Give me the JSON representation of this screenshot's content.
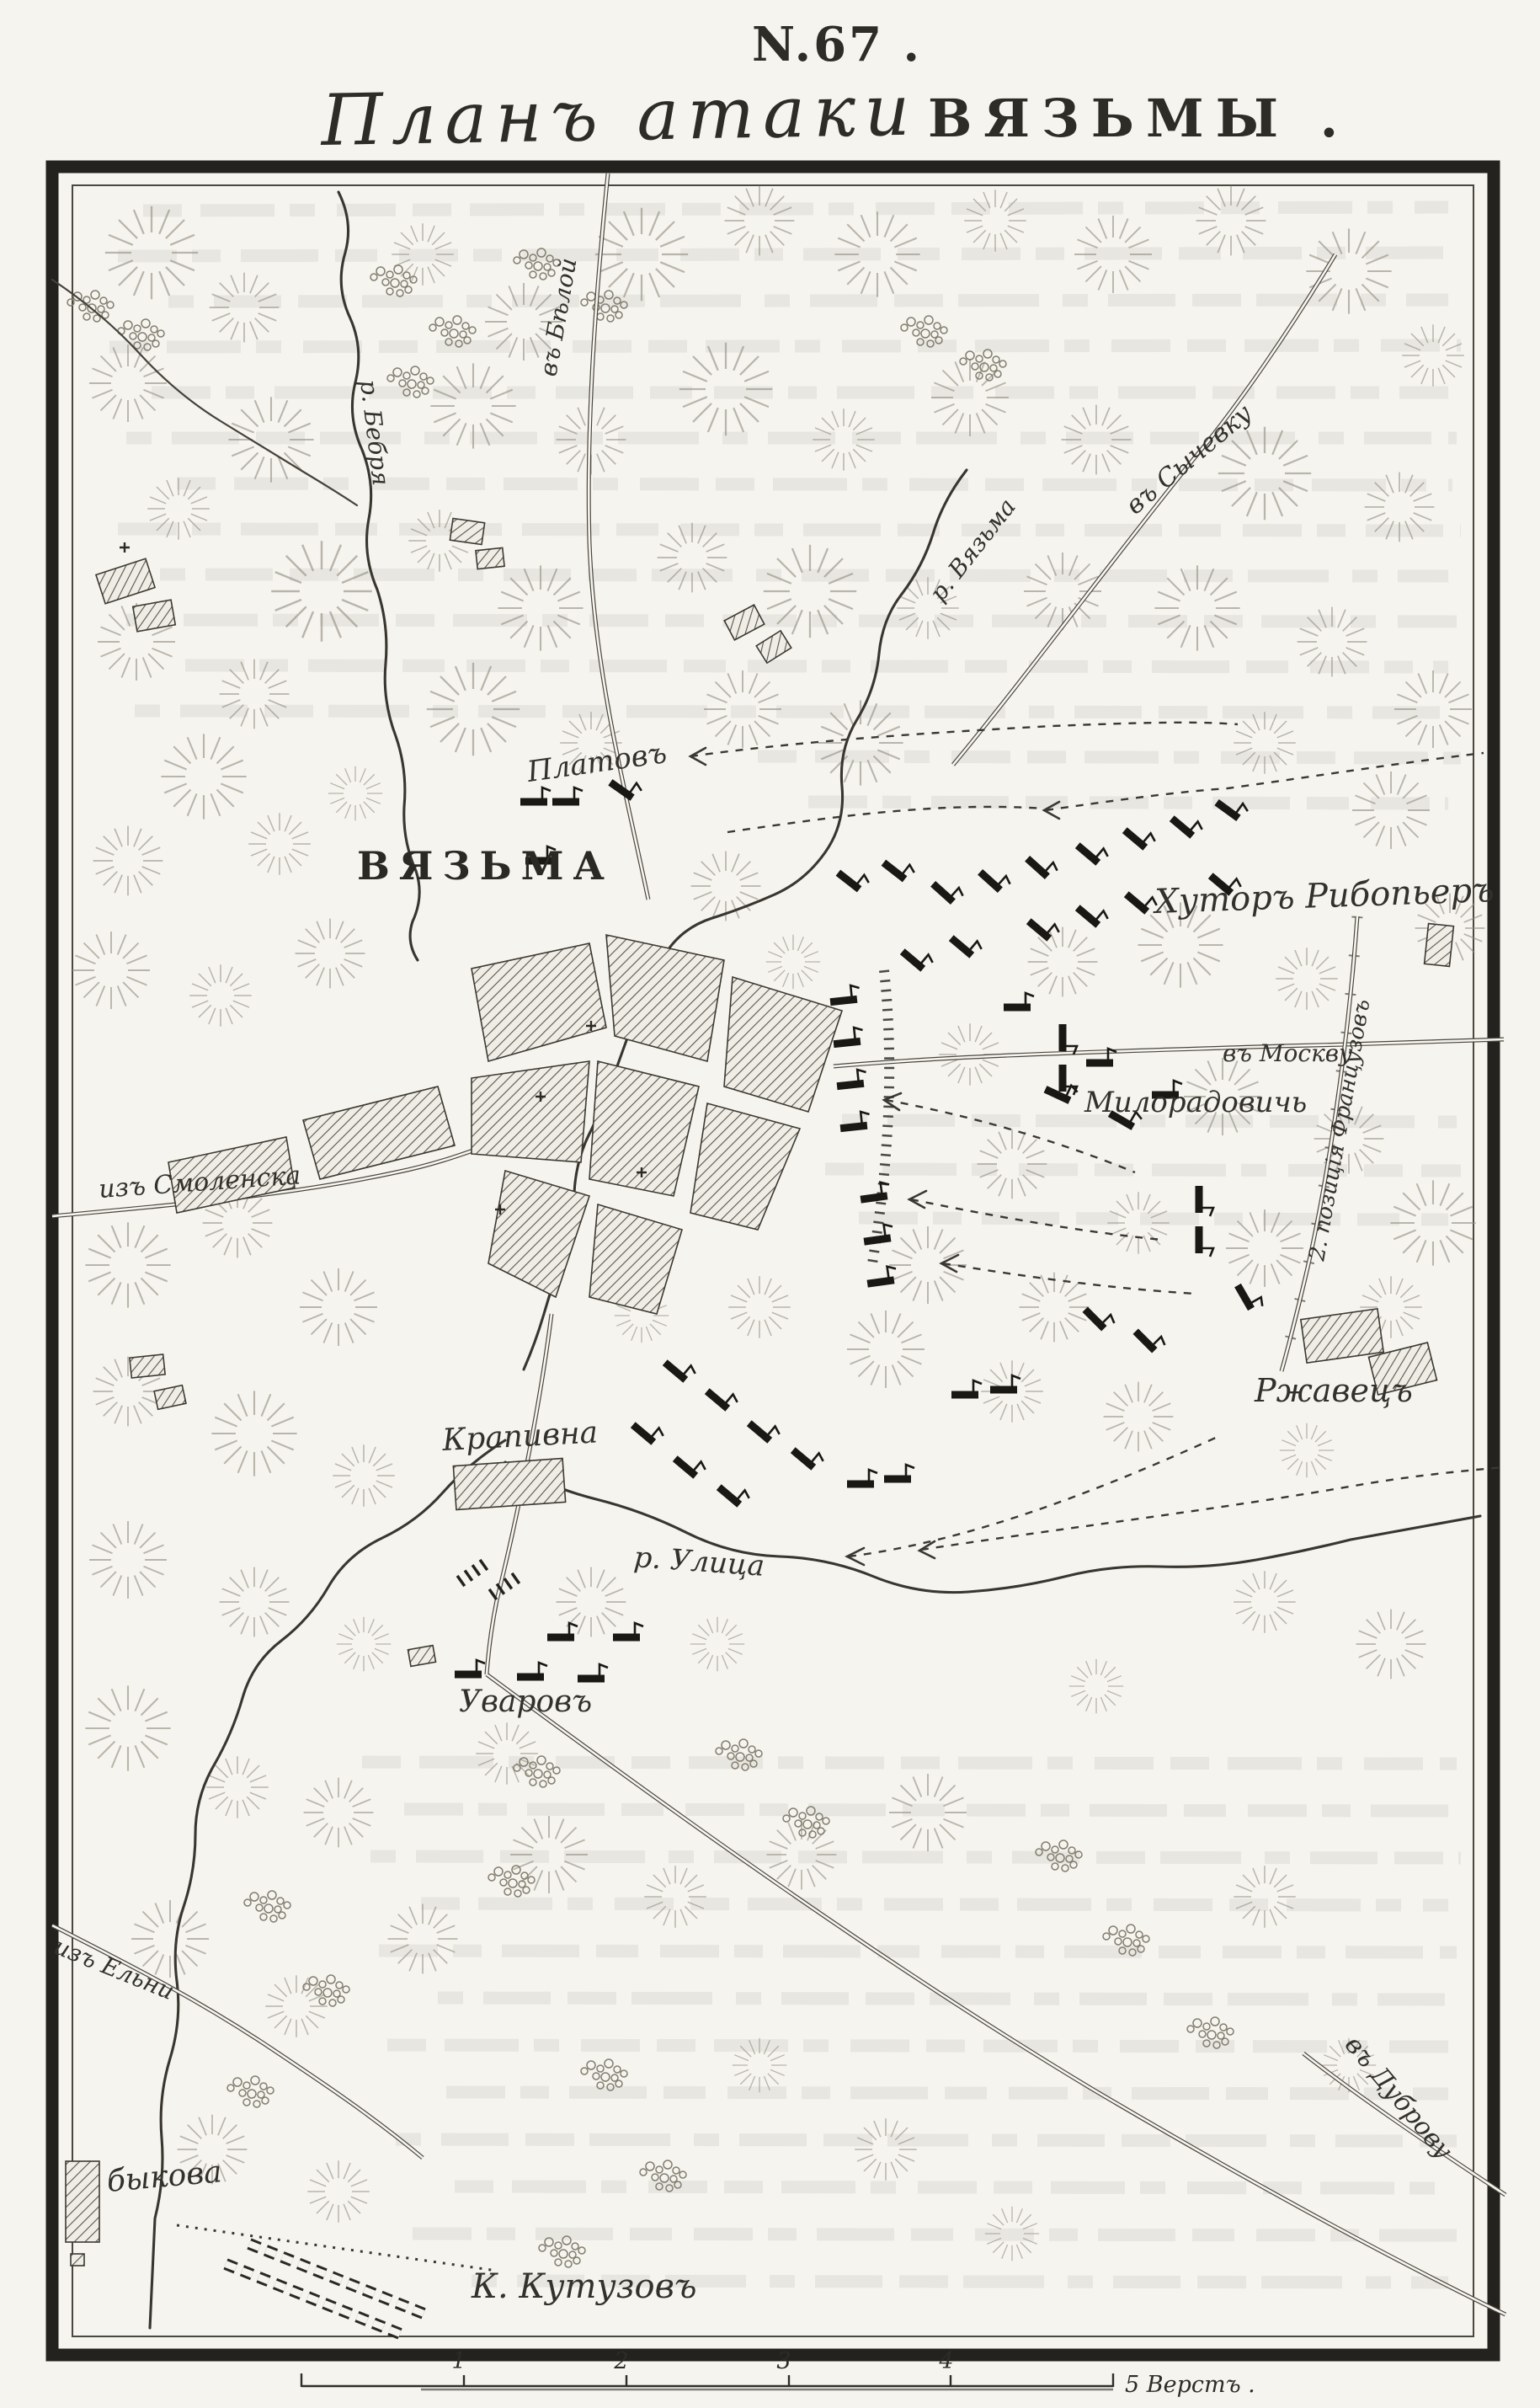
{
  "page": {
    "number_label": "N.67 .",
    "title_script": "Планъ атаки",
    "title_caps": "ВЯЗЬМЫ ."
  },
  "map": {
    "labels": {
      "platov": "Платовъ",
      "vyazma_city": "ВЯЗЬМА",
      "khutor_ribopier": "Хуторъ Рибопьеръ",
      "miloradovich": "Милорадовичь",
      "iz_smolenska": "изъ Смоленска",
      "rzhavets": "Ржавецъ",
      "krapivna": "Крапивна",
      "r_ulitsa": "р. Улица",
      "uvarov": "Уваровъ",
      "bykova": "быкова",
      "k_kutuzov": "К. Кутузовъ",
      "iz_elni": "изъ Ельни",
      "v_dubrovu": "въ Дуброву",
      "v_beloy": "въ Бѣлой",
      "v_sychevku": "въ Сычевку",
      "r_bebrya": "р. Бебря",
      "r_vyazma": "р. Вязьма",
      "v_moskvu": "въ Москву",
      "pozitsia_frantsuzov": "2. позиція Французовъ"
    },
    "scale": {
      "ticks": [
        "1",
        "2",
        "3",
        "4"
      ],
      "end_label": "5 Верстъ ."
    }
  },
  "colors": {
    "paper": "#f6f4ee",
    "ink": "#2e2c27",
    "frame": "#23221e"
  }
}
